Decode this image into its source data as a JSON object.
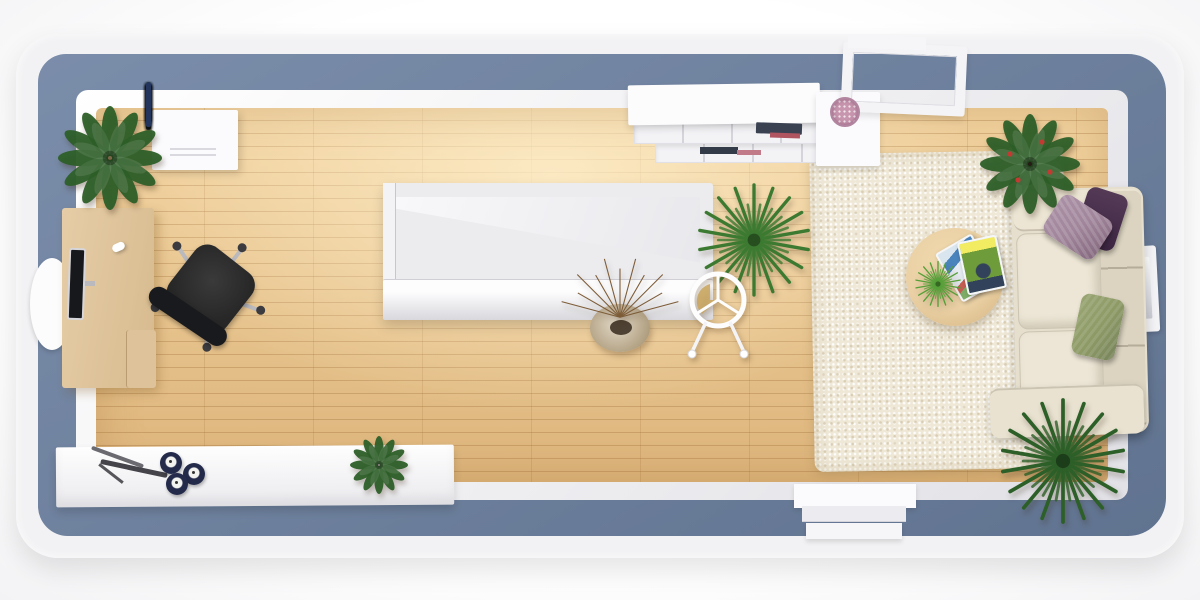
{
  "scene": {
    "type": "3d-floor-plan-top-view",
    "description": "Photoreal top-down 3D render of a narrow studio living room with slate-blue walls, oak plank floor, staircase in the center, home-office corner on the left and lounge area with sofa and shag rug on the right. No visible text anywhere in the image.",
    "visible_text": []
  },
  "palette": {
    "outer-band": "#f2f2f4",
    "wall": "#6b80a0",
    "floor-light": "#f2d3a0",
    "floor-dark": "#ddb57c",
    "plank-line": "rgba(151,101,47,0.30)",
    "desk-wood": "#e6cda7",
    "chair-black": "#272727",
    "metal-silver": "#b9b9be",
    "rug": "#efe8d7",
    "sofa": "#e6dfce",
    "sofa-back": "#dcd4c1",
    "pillow-light-purple": "#a1869b",
    "pillow-dark-purple": "#4b2f4a",
    "pillow-olive": "#8d9a66",
    "table-wood": "#ead0a4",
    "plant-dark": "#2d5f28",
    "plant-mid": "#3c7a31",
    "plant-bright": "#55a038",
    "twig-brown": "#7d5c38",
    "candle-navy": "#232a4a",
    "plate-pink": "#c795ae",
    "book-navy": "#3a4252",
    "book-red": "#b05560",
    "magazine-blue": "#4a84bd",
    "magazine-green": "#6f9c3a",
    "magazine-yellow": "#f2ec62"
  },
  "clothes": {
    "colors": [
      "#1f7d7d",
      "#2f66ad",
      "#14161a",
      "#57a04a",
      "#3a3f45",
      "#1f6d6d",
      "#b9584a",
      "#16181c",
      "#2a3c66",
      "#8a9096",
      "#4f9a45",
      "#2b57a0",
      "#101215",
      "#9bbf86",
      "#23355c"
    ],
    "heights": [
      40,
      46,
      38,
      44,
      48,
      40,
      45,
      38,
      46,
      36,
      44,
      40,
      47,
      39,
      45
    ]
  },
  "stairs": {
    "tread_count": 10
  },
  "candles": {
    "count": 3
  },
  "objects": [
    {
      "name": "wardrobe-with-clothes",
      "note": "white dresser with colorful garments on rail, top-left"
    },
    {
      "name": "bushy-plant",
      "note": "green potted plant beside wardrobe"
    },
    {
      "name": "office-desk",
      "note": "light oak desk with monitor and white mouse, left wall"
    },
    {
      "name": "round-wall-mirror",
      "note": "white oval on left wall"
    },
    {
      "name": "office-chair",
      "note": "black swivel chair with silver star base"
    },
    {
      "name": "white-sideboard",
      "note": "long unit along bottom wall with metal sculpture, three navy candles and rosette plant"
    },
    {
      "name": "staircase",
      "note": "white enclosed staircase with diagonal stringer and balustrade, center"
    },
    {
      "name": "twig-vase",
      "note": "beige pot with dry branches below stairs"
    },
    {
      "name": "yucca-plant",
      "note": "spiky palm right of staircase"
    },
    {
      "name": "ring-chair",
      "note": "white wireframe chair with tan cushion"
    },
    {
      "name": "tv-console",
      "note": "white shelving unit with books and pink dotted plate, top wall"
    },
    {
      "name": "wall-crossing-frame",
      "note": "white desk/frame passing through top-right wall opening"
    },
    {
      "name": "shag-rug",
      "note": "cream high-pile rug"
    },
    {
      "name": "sofa",
      "note": "cream fabric sofa with light-purple, dark-purple and olive pillows"
    },
    {
      "name": "right-wall-window",
      "note": "small white frame recessed in right wall"
    },
    {
      "name": "coffee-table",
      "note": "round wooden table with two comic magazines and succulent"
    },
    {
      "name": "houseplant-red-berries",
      "note": "dark-leaf plant in brown pot, top-right corner"
    },
    {
      "name": "palm-plant",
      "note": "large spiky palm, bottom-right corner"
    },
    {
      "name": "door-threshold",
      "note": "white doorway with two steps through bottom wall"
    }
  ]
}
